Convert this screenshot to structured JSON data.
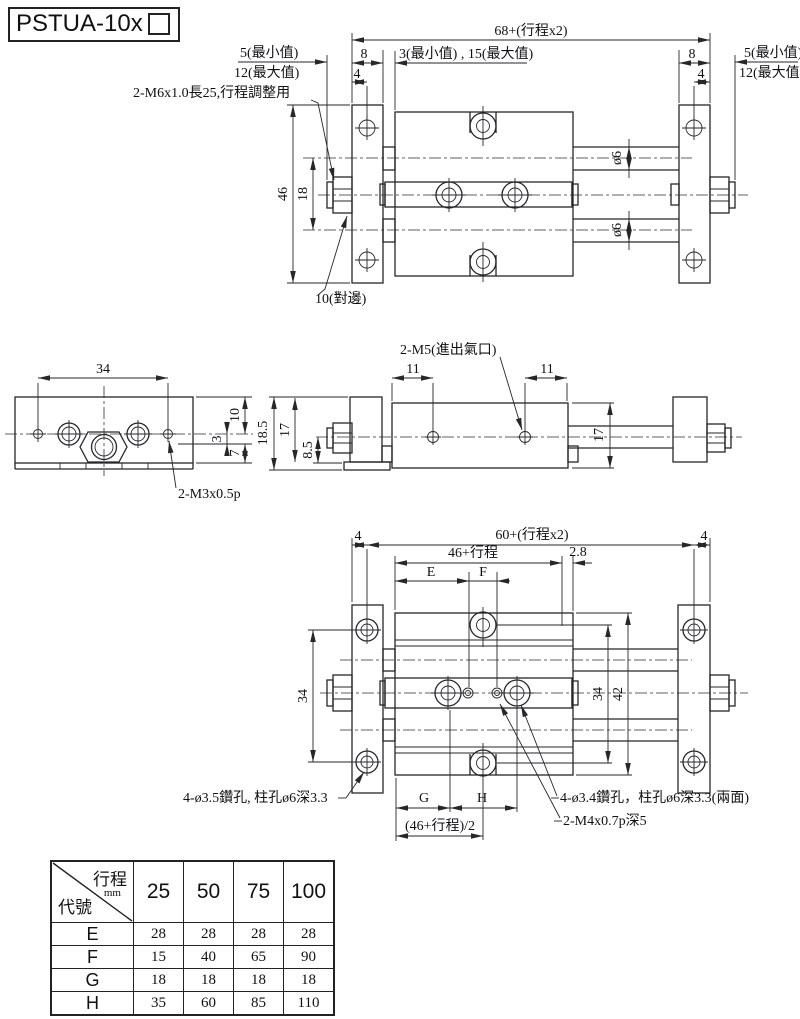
{
  "title": {
    "model": "PSTUA-10x"
  },
  "top_view": {
    "dim_total": "68+(行程x2)",
    "dim_min5_left": "5(最小值)",
    "dim_max12_left": "12(最大值)",
    "dim_8_left": "8",
    "dim_4_left": "4",
    "dim_min_max": "3(最小值) , 15(最大值)",
    "dim_8_right": "8",
    "dim_4_right": "4",
    "dim_min5_right": "5(最小值)",
    "dim_max12_right": "12(最大值)",
    "label_adjuster": "2-M6x1.0長25,行程調整用",
    "dim_46": "46",
    "dim_18": "18",
    "dim_rod_dia_top": "ø6",
    "dim_rod_dia_bottom": "ø6",
    "label_wrench": "10(對邊)"
  },
  "end_view": {
    "dim_34": "34",
    "dim_10": "10",
    "dim_3": "3",
    "dim_7": "7",
    "label_thread": "2-M3x0.5p"
  },
  "side_view": {
    "label_port": "2-M5(進出氣口)",
    "dim_11_left": "11",
    "dim_11_right": "11",
    "dim_18_5": "18.5",
    "dim_17_left": "17",
    "dim_8_5": "8.5",
    "dim_17_right": "17"
  },
  "bottom_view": {
    "dim_4_left": "4",
    "dim_total": "60+(行程x2)",
    "dim_4_right": "4",
    "dim_stroke": "46+行程",
    "dim_2_8": "2.8",
    "dim_E": "E",
    "dim_F": "F",
    "dim_34_left": "34",
    "dim_34_right": "34",
    "dim_42": "42",
    "dim_G": "G",
    "dim_H": "H",
    "dim_half": "(46+行程)/2",
    "label_cb_left": "4-ø3.5鑽孔, 柱孔ø6深3.3",
    "label_cb_right": "4-ø3.4鑽孔，柱孔ø6深3.3(兩面)",
    "label_tap": "2-M4x0.7p深5"
  },
  "table": {
    "corner_top": "行程",
    "corner_unit": "mm",
    "corner_bottom": "代號",
    "columns": [
      "25",
      "50",
      "75",
      "100"
    ],
    "rows": [
      {
        "code": "E",
        "values": [
          "28",
          "28",
          "28",
          "28"
        ]
      },
      {
        "code": "F",
        "values": [
          "15",
          "40",
          "65",
          "90"
        ]
      },
      {
        "code": "G",
        "values": [
          "18",
          "18",
          "18",
          "18"
        ]
      },
      {
        "code": "H",
        "values": [
          "35",
          "60",
          "85",
          "110"
        ]
      }
    ]
  }
}
